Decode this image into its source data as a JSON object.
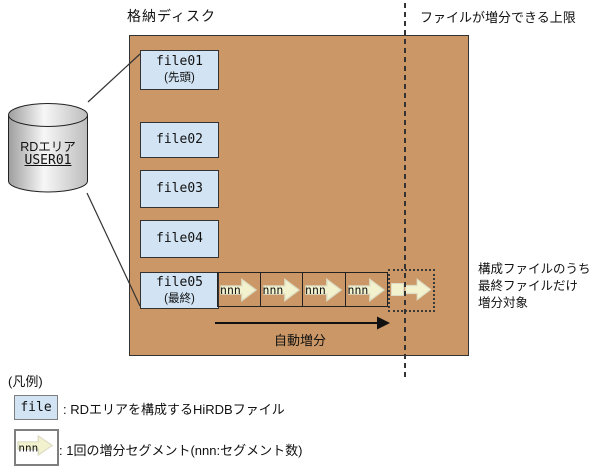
{
  "colors": {
    "disk_bg": "#CB9766",
    "filebox_bg": "#D2E4F4",
    "arrow_fill": "#F2F2CE",
    "arrow_stroke": "#DCDCC4"
  },
  "header": {
    "disk_title": "格納ディスク",
    "limit_label": "ファイルが増分できる上限"
  },
  "cylinder": {
    "title": "RDエリア",
    "name": "USER01"
  },
  "files": [
    {
      "name": "file01",
      "note": "(先頭)"
    },
    {
      "name": "file02",
      "note": ""
    },
    {
      "name": "file03",
      "note": ""
    },
    {
      "name": "file04",
      "note": ""
    },
    {
      "name": "file05",
      "note": "(最終)"
    }
  ],
  "diagram": {
    "segment_label": "nnn",
    "segment_count": 4,
    "auto_extend_label": "自動増分",
    "annotation": "構成ファイルのうち\n最終ファイルだけ\n増分対象"
  },
  "legend": {
    "title": "(凡例)",
    "items": [
      {
        "symbol": "file",
        "description": ": RDエリアを構成するHiRDBファイル"
      },
      {
        "symbol": "nnn",
        "description": ": 1回の増分セグメント(nnn:セグメント数)"
      }
    ]
  }
}
